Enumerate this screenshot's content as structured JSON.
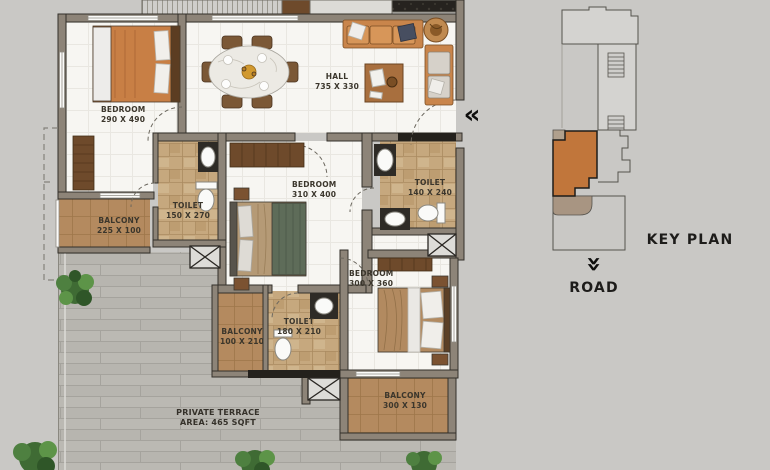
{
  "plan": {
    "rooms": [
      {
        "name": "BEDROOM",
        "dims": "290 X 490"
      },
      {
        "name": "HALL",
        "dims": "735 X 330"
      },
      {
        "name": "TOILET",
        "dims": "150 X 270"
      },
      {
        "name": "BEDROOM",
        "dims": "310 X 400"
      },
      {
        "name": "TOILET",
        "dims": "140 X 240"
      },
      {
        "name": "BALCONY",
        "dims": "225 X 100"
      },
      {
        "name": "BALCONY",
        "dims": "100 X 210"
      },
      {
        "name": "TOILET",
        "dims": "180 X 210"
      },
      {
        "name": "BEDROOM",
        "dims": "300 X 360"
      },
      {
        "name": "BALCONY",
        "dims": "300 X 130"
      }
    ],
    "terrace": {
      "name": "PRIVATE TERRACE",
      "area": "AREA: 465 SQFT"
    }
  },
  "key_plan": {
    "title": "KEY PLAN",
    "road": "ROAD"
  },
  "icons": {
    "entry_arrow": "«",
    "road_arrow": "»"
  },
  "colors": {
    "background": "#c9c8c5",
    "floor": "#f7f6f2",
    "wall": "#8d8478",
    "balcony_floor": "#b48a5f",
    "toilet_floor": "#c6a87e",
    "terrace_floor": "#b7b5af",
    "highlight_unit": "#c1763b",
    "wood": "#6e4a2b",
    "text": "#3b362c"
  }
}
